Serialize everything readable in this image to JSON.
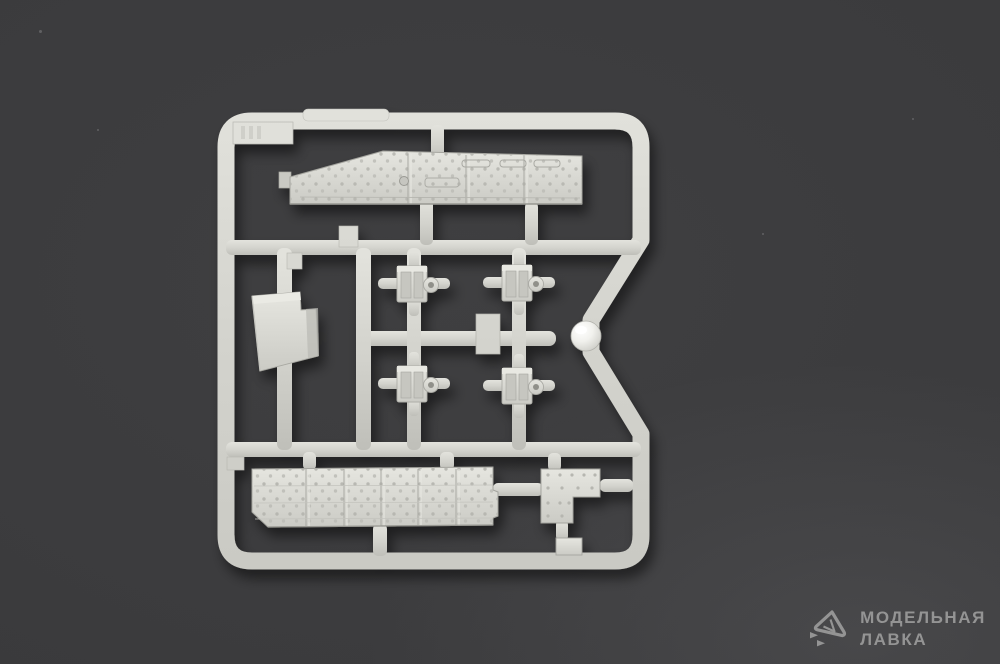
{
  "scene": {
    "description": "Top-down photograph of a light grey injection-moulded plastic model-kit sprue (parts frame) lying on a dark grey surface",
    "colors": {
      "background": "#3b3b3d",
      "plastic": "#d4d4ce",
      "plastic_shadow": "#b2b2ac",
      "dome_highlight": "#ffffff",
      "watermark": "#9b9b9b"
    }
  },
  "sprue": {
    "shape": "rounded-square runner frame with a V-shaped notch on the right edge",
    "parts": [
      {
        "name": "hull-side-panel",
        "description": "long riveted armour panel with sloped front end",
        "location": "top"
      },
      {
        "name": "equipment-box",
        "description": "rectangular box-shaped part",
        "location": "left middle"
      },
      {
        "name": "mount-bracket",
        "description": "small bracket with tow ring",
        "location": "centre, 2x2 grid",
        "count": 4
      },
      {
        "name": "polished-dome",
        "description": "shiny hemispherical part sitting in the frame notch",
        "location": "right middle"
      },
      {
        "name": "floor-panel",
        "description": "long riveted panel with bolt rows",
        "location": "bottom"
      },
      {
        "name": "l-shaped-plate",
        "description": "L-shaped riveted plate",
        "location": "bottom right"
      },
      {
        "name": "small-square-plate",
        "description": "small square plate",
        "location": "below the L-shaped plate"
      }
    ]
  },
  "watermark": {
    "logo": "paper-plane-icon",
    "line1": "МОДЕЛЬНАЯ",
    "line2": "ЛАВКА",
    "color": "#9b9b9b"
  }
}
